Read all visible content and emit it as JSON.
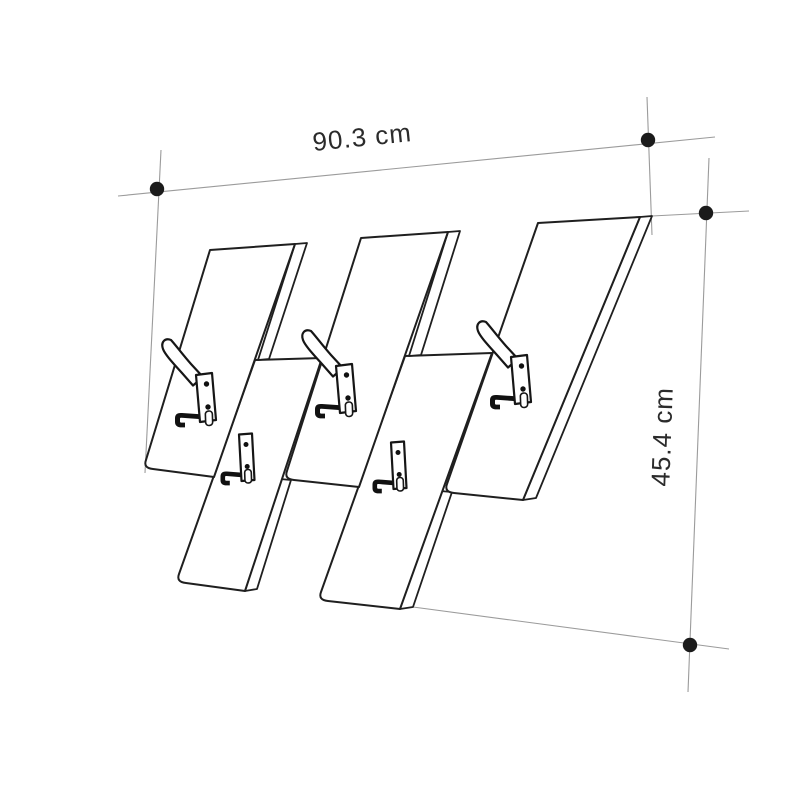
{
  "diagram": {
    "title": "coat-rack-dimension-drawing",
    "dimensions": {
      "width_label": "90.3 cm",
      "height_label": "45.4 cm"
    },
    "figure": {
      "upper_panels": 3,
      "lower_panels": 2,
      "large_hooks": 3,
      "small_hooks": 2
    },
    "colors": {
      "background": "#ffffff",
      "drawing_line": "#1f1f1f",
      "dimension_line": "#9b9b9b",
      "marker_dot": "#1b1b1b",
      "label_text": "#2b2b2b"
    }
  }
}
